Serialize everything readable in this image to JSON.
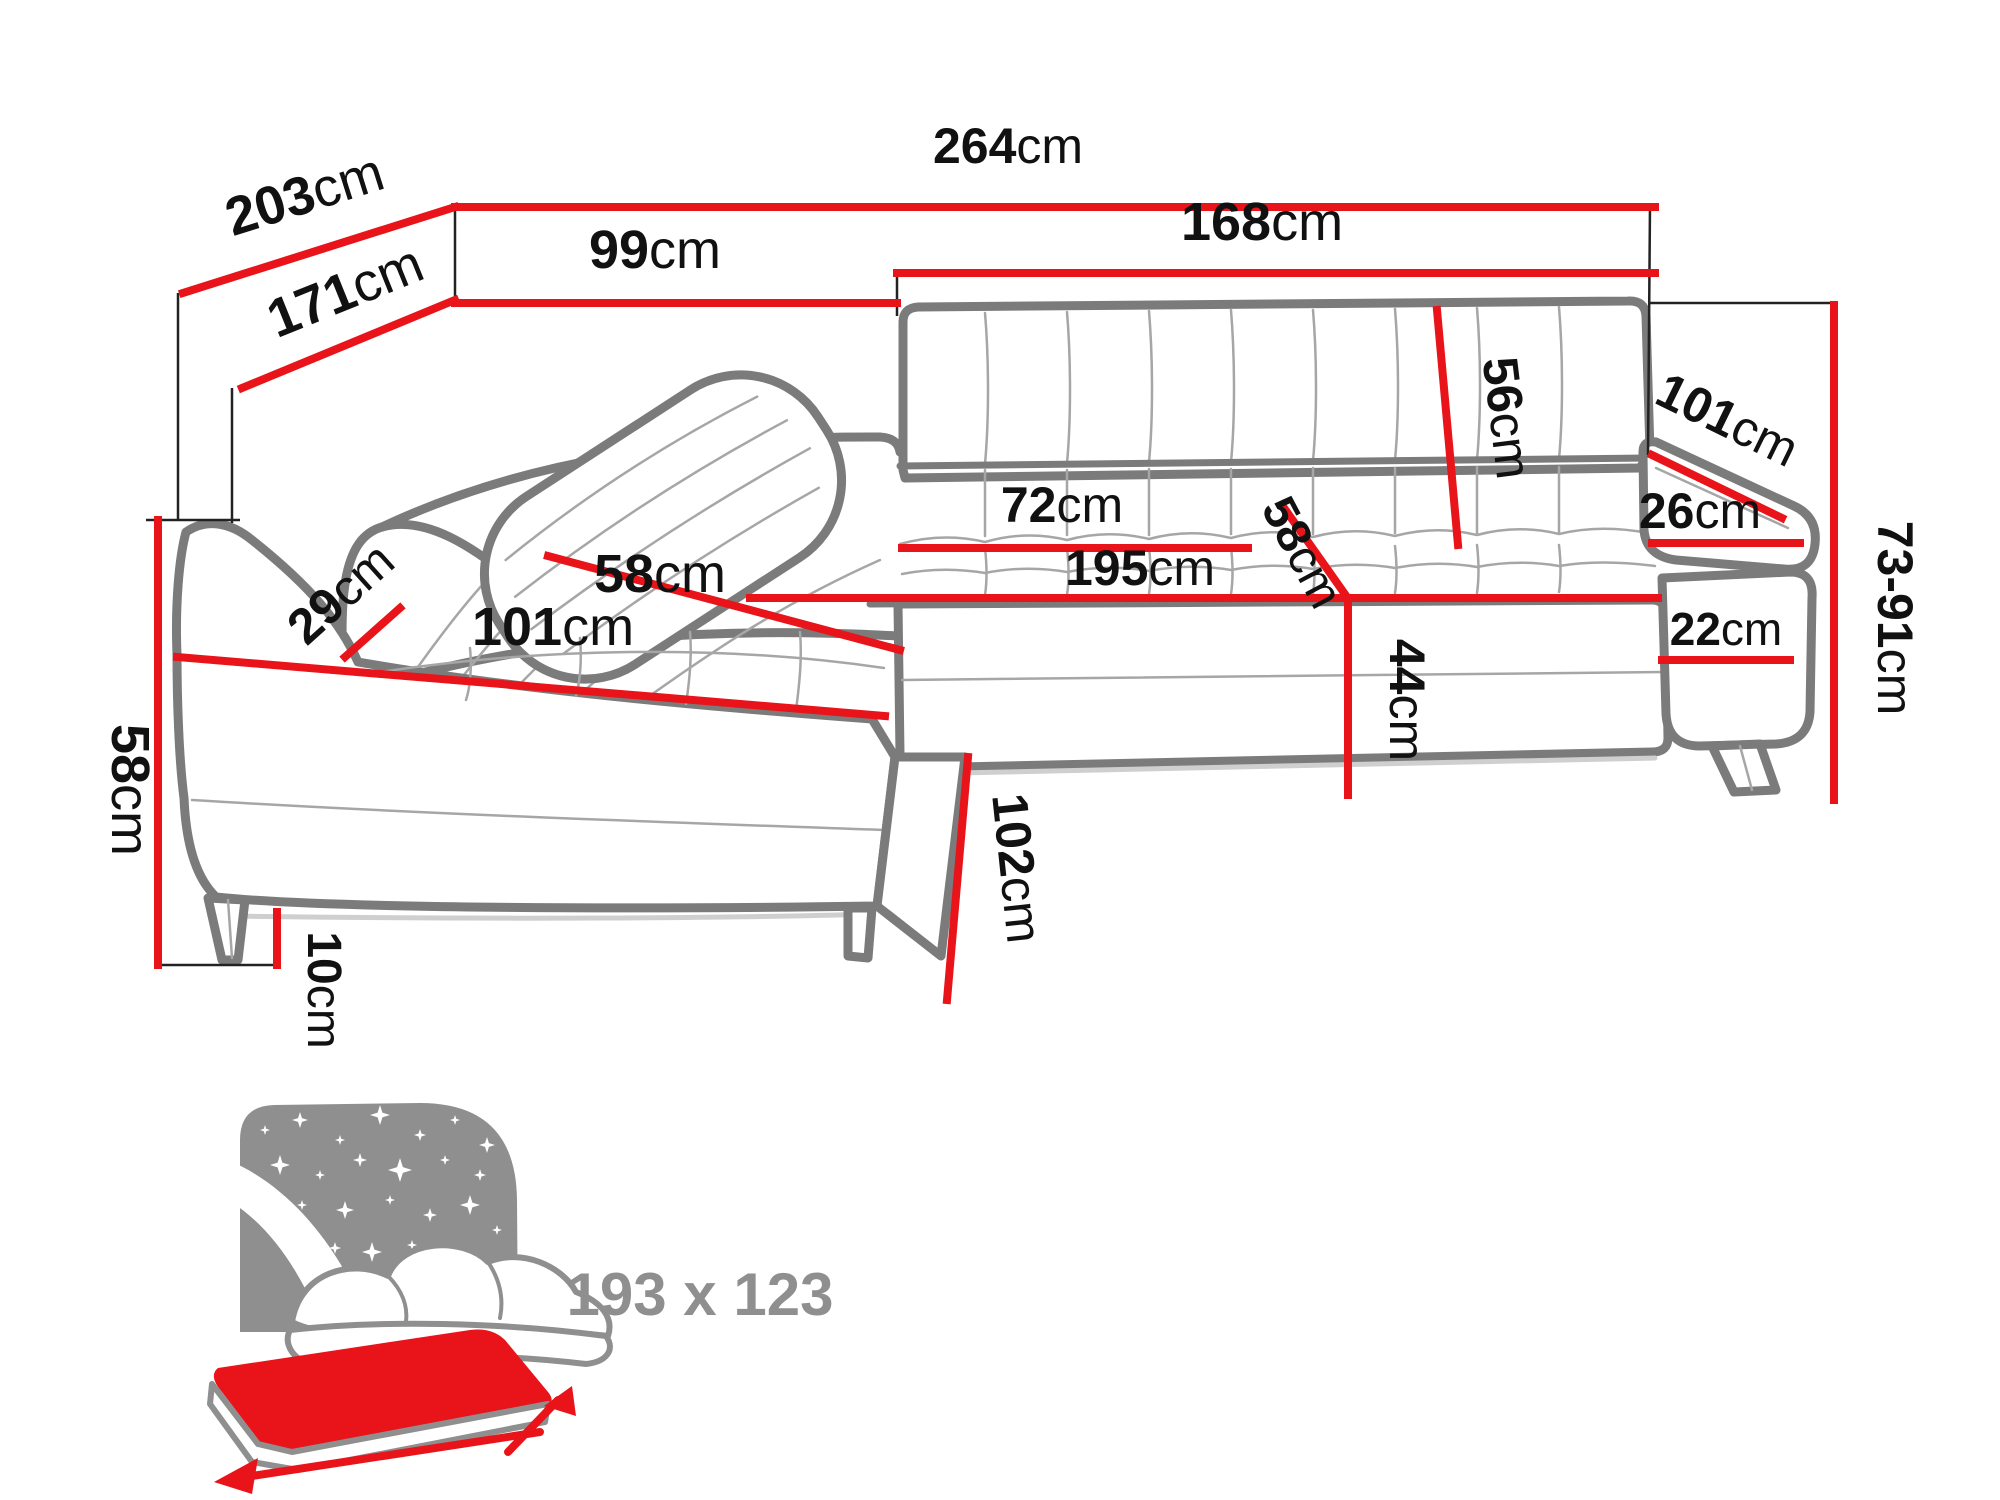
{
  "diagram": {
    "type": "furniture-dimension-diagram",
    "subject": "corner sofa bed with chaise",
    "canvas": {
      "width": 2000,
      "height": 1500
    },
    "colors": {
      "dimension_line": "#e8141a",
      "sofa_outline": "#7b7b7b",
      "sofa_detail": "#a6a6a6",
      "reference_line": "#222222",
      "label_text": "#111111",
      "icon_gray": "#8f8f8f"
    },
    "measurements": {
      "overall_width": {
        "value": "264",
        "unit": "cm"
      },
      "total_depth": {
        "value": "203",
        "unit": "cm"
      },
      "chaise_depth": {
        "value": "171",
        "unit": "cm"
      },
      "corner_width": {
        "value": "99",
        "unit": "cm"
      },
      "seat_front_width": {
        "value": "168",
        "unit": "cm"
      },
      "backrest_height": {
        "value": "56",
        "unit": "cm"
      },
      "armrest_length": {
        "value": "101",
        "unit": "cm"
      },
      "armrest_width": {
        "value": "26",
        "unit": "cm"
      },
      "seat_depth": {
        "value": "72",
        "unit": "cm"
      },
      "seat_length": {
        "value": "195",
        "unit": "cm"
      },
      "seat_depth_right": {
        "value": "58",
        "unit": "cm"
      },
      "seat_height": {
        "value": "44",
        "unit": "cm"
      },
      "armrest_above_seat": {
        "value": "22",
        "unit": "cm"
      },
      "back_height_range": {
        "value": "73-91",
        "unit": "cm"
      },
      "chaise_side_length": {
        "value": "102",
        "unit": "cm"
      },
      "side_height": {
        "value": "58",
        "unit": "cm"
      },
      "bolster_width": {
        "value": "29",
        "unit": "cm"
      },
      "chaise_seat_width": {
        "value": "58",
        "unit": "cm"
      },
      "chaise_length": {
        "value": "101",
        "unit": "cm"
      },
      "leg_height": {
        "value": "10",
        "unit": "cm"
      }
    },
    "sleeping_function": {
      "bed_size": "193 x 123"
    }
  }
}
